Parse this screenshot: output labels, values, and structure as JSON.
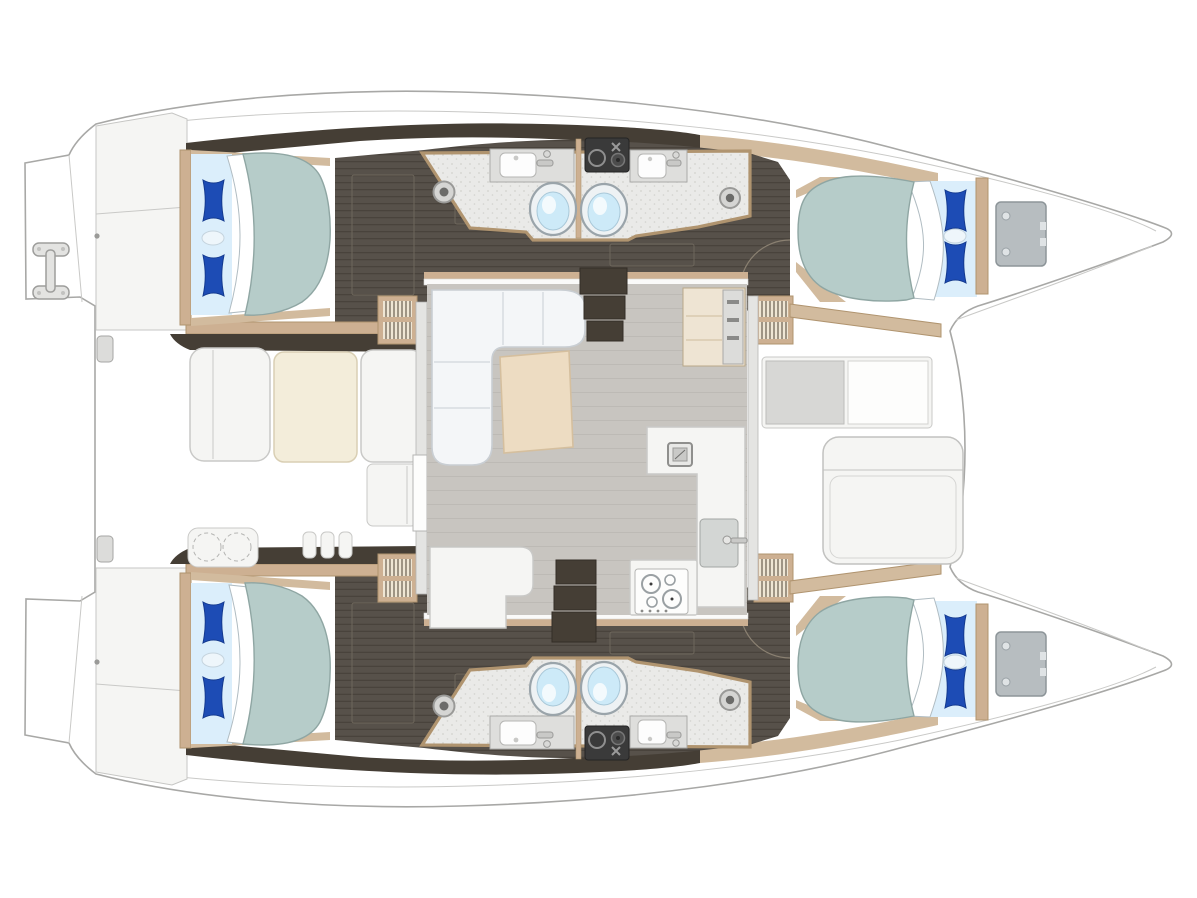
{
  "plan": {
    "kind": "catamaran-interior-floor-plan",
    "orientation": {
      "bow": "right",
      "stern": "left",
      "port_hull": "top",
      "starboard_hull": "bottom"
    },
    "counts": {
      "cabins": 4,
      "double_beds": 4,
      "heads": 4,
      "toilets": 4,
      "sinks_heads": 4,
      "shower_drains": 4,
      "salon": 1,
      "galley": 1,
      "aft_cockpit": 1,
      "forward_cockpit": 1,
      "companionway_stairs": 4,
      "foredeck_hatches": 2,
      "boarding_ladder": 1
    },
    "legend": {
      "bed": "double berth with two blue pillows and turned-down sheet",
      "head": "bathroom with sink, toilet and shower drain",
      "louver": "companionway stair with slatted treads",
      "dark_floor": "hull corridor wood flooring",
      "speckled_floor": "bathroom floor",
      "gray_floor": "salon floor",
      "equipment_block": "technical compartment between the two heads of each hull"
    }
  },
  "colors": {
    "deck": "#fbfbfa",
    "deckPanel": "#f5f5f3",
    "outline": "#a8a8a6",
    "lineLight": "#c9c9c7",
    "woodDark": "#453e35",
    "woodFloorBase": "#57514a",
    "woodFloorLine": "#49433c",
    "trimWood": "#cdb092",
    "trimWood2": "#d2bb9e",
    "trimWoodDark": "#b0946f",
    "bathFloor": "#eaeae8",
    "bathSpeckle": "#d2d2ce",
    "counter": "#dededc",
    "basinWhite": "#fdfdfd",
    "fixtureStroke": "#a9a9a7",
    "toiletRim": "#9aa4aa",
    "toiletWater": "#cdeaf8",
    "mattress": "#b6ccc9",
    "mattressEdge": "#8fa6a3",
    "sheetBlue": "#dbeefb",
    "foldWhite": "#ffffff",
    "pillowBlue": "#1d4cb5",
    "pillowDark": "#143a8f",
    "salonFloor": "#c8c5c0",
    "salonFloorLine": "#bdbab5",
    "sofa": "#f4f6f8",
    "sofaLine": "#c9ced3",
    "tableWood": "#eddcc2",
    "tableWoodEdge": "#d5bf9e",
    "cockpitTable": "#f3edda",
    "grayHatch": "#b7bdc0",
    "grayHatchEdge": "#8d9599",
    "equipDark": "#3a3a3a",
    "wallGray": "#e4e4e2",
    "louverLight": "#efe6d4",
    "louverShadow": "#7c7262",
    "footwellGray": "#d7d7d5"
  }
}
